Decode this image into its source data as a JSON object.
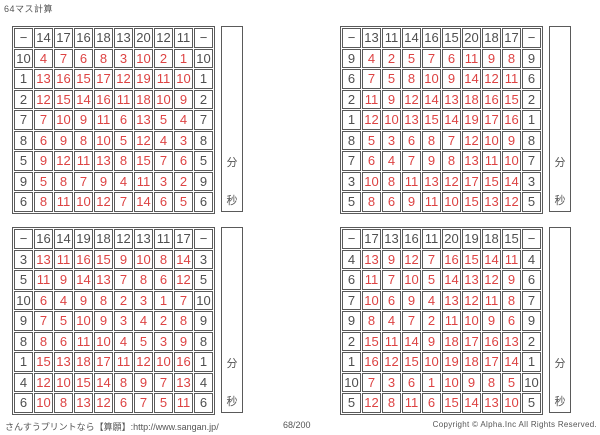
{
  "title": "64マス計算",
  "timer": {
    "minutes_label": "分",
    "seconds_label": "秒"
  },
  "footer": {
    "site": "さんすうプリントなら【算願】:http://www.sangan.jp/",
    "page_number": "68/200",
    "copyright": "Copyright © Alpha.Inc All Rights Reserved."
  },
  "colors": {
    "answer_red": "#dd4343",
    "header_gray": "#4f4f4f",
    "grid_line": "#5a5a5a"
  },
  "grids": [
    {
      "operator": "−",
      "top": [
        14,
        17,
        16,
        18,
        13,
        20,
        12,
        11
      ],
      "left": [
        10,
        1,
        2,
        7,
        8,
        5,
        9,
        6
      ],
      "answers": [
        [
          4,
          7,
          6,
          8,
          3,
          10,
          2,
          1
        ],
        [
          13,
          16,
          15,
          17,
          12,
          19,
          11,
          10
        ],
        [
          12,
          15,
          14,
          16,
          11,
          18,
          10,
          9
        ],
        [
          7,
          10,
          9,
          11,
          6,
          13,
          5,
          4
        ],
        [
          6,
          9,
          8,
          10,
          5,
          12,
          4,
          3
        ],
        [
          9,
          12,
          11,
          13,
          8,
          15,
          7,
          6
        ],
        [
          5,
          8,
          7,
          9,
          4,
          11,
          3,
          2
        ],
        [
          8,
          11,
          10,
          12,
          7,
          14,
          6,
          5
        ]
      ]
    },
    {
      "operator": "−",
      "top": [
        13,
        11,
        14,
        16,
        15,
        20,
        18,
        17
      ],
      "left": [
        9,
        6,
        2,
        1,
        8,
        7,
        3,
        5
      ],
      "answers": [
        [
          4,
          2,
          5,
          7,
          6,
          11,
          9,
          8
        ],
        [
          7,
          5,
          8,
          10,
          9,
          14,
          12,
          11
        ],
        [
          11,
          9,
          12,
          14,
          13,
          18,
          16,
          15
        ],
        [
          12,
          10,
          13,
          15,
          14,
          19,
          17,
          16
        ],
        [
          5,
          3,
          6,
          8,
          7,
          12,
          10,
          9
        ],
        [
          6,
          4,
          7,
          9,
          8,
          13,
          11,
          10
        ],
        [
          10,
          8,
          11,
          13,
          12,
          17,
          15,
          14
        ],
        [
          8,
          6,
          9,
          11,
          10,
          15,
          13,
          12
        ]
      ]
    },
    {
      "operator": "−",
      "top": [
        16,
        14,
        19,
        18,
        12,
        13,
        11,
        17
      ],
      "left": [
        3,
        5,
        10,
        9,
        8,
        1,
        4,
        6
      ],
      "answers": [
        [
          13,
          11,
          16,
          15,
          9,
          10,
          8,
          14
        ],
        [
          11,
          9,
          14,
          13,
          7,
          8,
          6,
          12
        ],
        [
          6,
          4,
          9,
          8,
          2,
          3,
          1,
          7
        ],
        [
          7,
          5,
          10,
          9,
          3,
          4,
          2,
          8
        ],
        [
          8,
          6,
          11,
          10,
          4,
          5,
          3,
          9
        ],
        [
          15,
          13,
          18,
          17,
          11,
          12,
          10,
          16
        ],
        [
          12,
          10,
          15,
          14,
          8,
          9,
          7,
          13
        ],
        [
          10,
          8,
          13,
          12,
          6,
          7,
          5,
          11
        ]
      ]
    },
    {
      "operator": "−",
      "top": [
        17,
        13,
        16,
        11,
        20,
        19,
        18,
        15
      ],
      "left": [
        4,
        6,
        7,
        9,
        2,
        1,
        10,
        5
      ],
      "answers": [
        [
          13,
          9,
          12,
          7,
          16,
          15,
          14,
          11
        ],
        [
          11,
          7,
          10,
          5,
          14,
          13,
          12,
          9
        ],
        [
          10,
          6,
          9,
          4,
          13,
          12,
          11,
          8
        ],
        [
          8,
          4,
          7,
          2,
          11,
          10,
          9,
          6
        ],
        [
          15,
          11,
          14,
          9,
          18,
          17,
          16,
          13
        ],
        [
          16,
          12,
          15,
          10,
          19,
          18,
          17,
          14
        ],
        [
          7,
          3,
          6,
          1,
          10,
          9,
          8,
          5
        ],
        [
          12,
          8,
          11,
          6,
          15,
          14,
          13,
          10
        ]
      ]
    }
  ]
}
